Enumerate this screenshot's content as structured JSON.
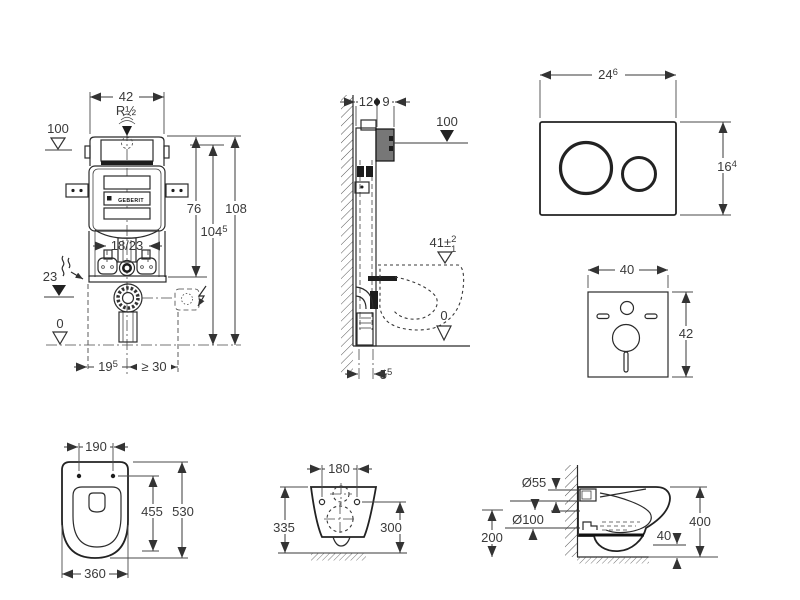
{
  "views": {
    "frame_front": {
      "width": "42",
      "supply": "R½",
      "level_top": "100",
      "height_cistern": "76",
      "height_frame": "104",
      "height_frame_sup": "5",
      "height_total": "108",
      "pipe_offset": "18/23",
      "level_mid": "23",
      "level_zero": "0",
      "offset_outlet": "19",
      "offset_outlet_sup": "5",
      "min_side": "≥ 30",
      "brand": "GEBERIT"
    },
    "frame_side": {
      "depth_frame": "12",
      "depth_box": "9",
      "level_top": "100",
      "seat_height": "41±",
      "seat_tol_plus": "2",
      "seat_tol_minus": "1",
      "level_zero": "0",
      "wall_offset": "5",
      "wall_offset_sup": "5"
    },
    "flush_plate": {
      "width": "24",
      "width_sup": "6",
      "height": "16",
      "height_sup": "4"
    },
    "sound_mat": {
      "width": "40",
      "height": "42"
    },
    "wc_top": {
      "hole_spacing": "190",
      "depth_inner": "455",
      "depth": "530",
      "width": "360"
    },
    "wc_rear": {
      "hole_spacing": "180",
      "height_left": "335",
      "height_right": "300"
    },
    "wc_side": {
      "flush_pipe": "Ø55",
      "outlet_pipe": "Ø100",
      "outlet_height": "200",
      "height": "400",
      "clearance": "40"
    }
  }
}
